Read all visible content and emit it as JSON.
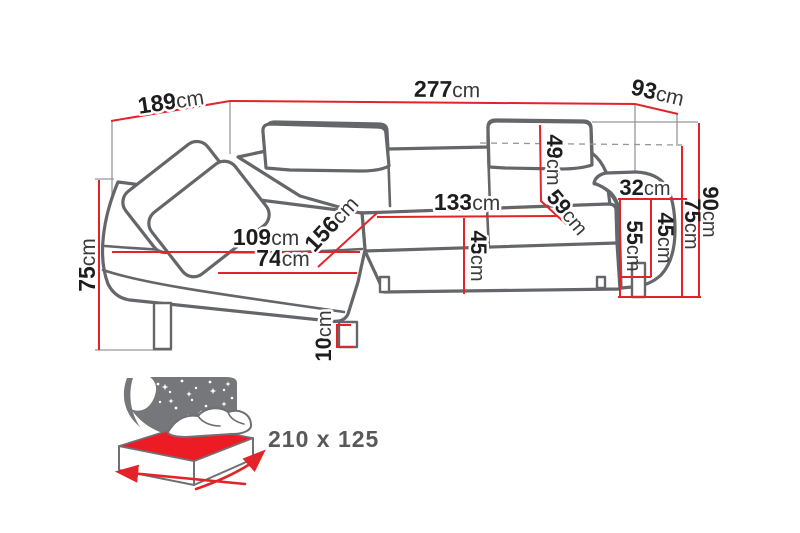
{
  "diagram": {
    "title": "corner-sofa-dimension-diagram",
    "dimensions": {
      "back_width": {
        "value": "189",
        "unit": "cm"
      },
      "total_width": {
        "value": "277",
        "unit": "cm"
      },
      "side_depth": {
        "value": "93",
        "unit": "cm"
      },
      "height_left": {
        "value": "75",
        "unit": "cm"
      },
      "total_height": {
        "value": "90",
        "unit": "cm"
      },
      "backrest_height": {
        "value": "75",
        "unit": "cm"
      },
      "headrest_height": {
        "value": "49",
        "unit": "cm"
      },
      "backrest_slant": {
        "value": "59",
        "unit": "cm"
      },
      "armrest_width": {
        "value": "32",
        "unit": "cm"
      },
      "seat_width": {
        "value": "133",
        "unit": "cm"
      },
      "seat_height": {
        "value": "45",
        "unit": "cm"
      },
      "armrest_height": {
        "value": "55",
        "unit": "cm"
      },
      "armrest_inner_height": {
        "value": "45",
        "unit": "cm"
      },
      "chaise_length": {
        "value": "156",
        "unit": "cm"
      },
      "chaise_width": {
        "value": "109",
        "unit": "cm"
      },
      "chaise_seat_width": {
        "value": "74",
        "unit": "cm"
      },
      "leg_height": {
        "value": "10",
        "unit": "cm"
      }
    },
    "sleeping_area": {
      "label": "210 x 125"
    },
    "icons": {
      "sleeping_function": "bed-with-starry-night-backdrop"
    },
    "colors": {
      "dimension_line": "#e2242a",
      "sofa_outline": "#646669",
      "construction_line": "#96979a",
      "label_text": "#1d1d1f",
      "icon_gray": "#76777a",
      "mattress_red": "#ed1c24",
      "size_text": "#58595b"
    }
  }
}
